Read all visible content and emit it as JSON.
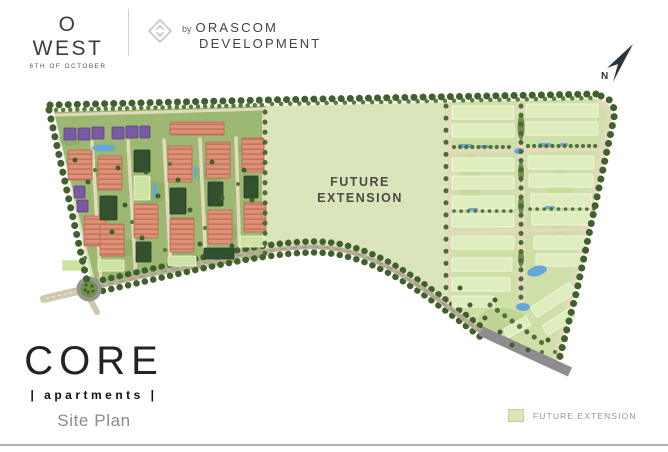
{
  "header": {
    "brand": {
      "name": "O WEST",
      "subtitle": "6TH OF OCTOBER"
    },
    "developer": {
      "prefix": "by",
      "line1": "ORASCOM",
      "line2": "DEVELOPMENT"
    }
  },
  "map": {
    "future_extension_lines": [
      "FUTURE",
      "EXTENSION"
    ],
    "north_label": "N"
  },
  "footer": {
    "project": "CORE",
    "subtitle": "| apartments |",
    "plan_label": "Site Plan"
  },
  "legend": {
    "items": [
      {
        "label": "FUTURE EXTENSION",
        "color": "#dbe5bc"
      }
    ]
  },
  "colors": {
    "future_extension": "#dbe5bc",
    "cluster_left_base": "#9cb873",
    "cluster_right_base": "#cfdfa8",
    "building_salmon": "#dd9178",
    "building_dark_green": "#33512f",
    "building_light_green": "#cde3a2",
    "building_purple": "#7a5aa5",
    "road_beige": "#e3dabb",
    "road_gray": "#8d8d8d",
    "tree_green": "#42602e",
    "water_blue": "#64a8d8",
    "heading_text": "#333e48",
    "muted_text": "#8b8b8b"
  }
}
